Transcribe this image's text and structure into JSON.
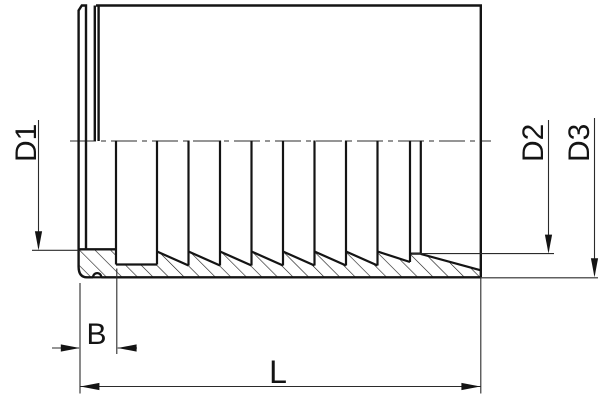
{
  "drawing": {
    "background": "#ffffff",
    "outline_color": "#141414",
    "thin_line_color": "#2b2b2b",
    "labels": {
      "d1": "D1",
      "d2": "D2",
      "d3": "D3",
      "b": "B",
      "l": "L"
    }
  }
}
